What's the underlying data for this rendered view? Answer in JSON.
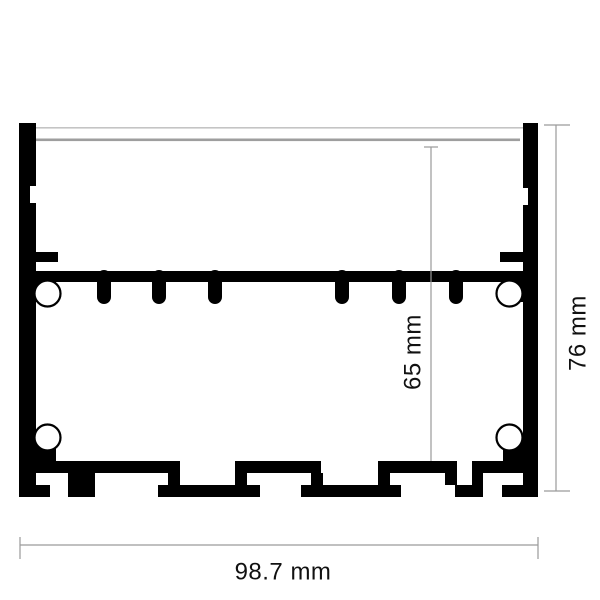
{
  "drawing": {
    "type": "led-aluminium-profile-cross-section",
    "dimensions": {
      "width_label": "98.7 mm",
      "height_label": "76 mm",
      "inner_height_label": "65 mm"
    },
    "colors": {
      "profile_body": "#000000",
      "dimension_line": "#9a9a9a",
      "dimension_text": "#111111",
      "cover_line_light": "#c4c4c4",
      "cover_line_dark": "#9e9e9e",
      "background": "#ffffff"
    }
  }
}
